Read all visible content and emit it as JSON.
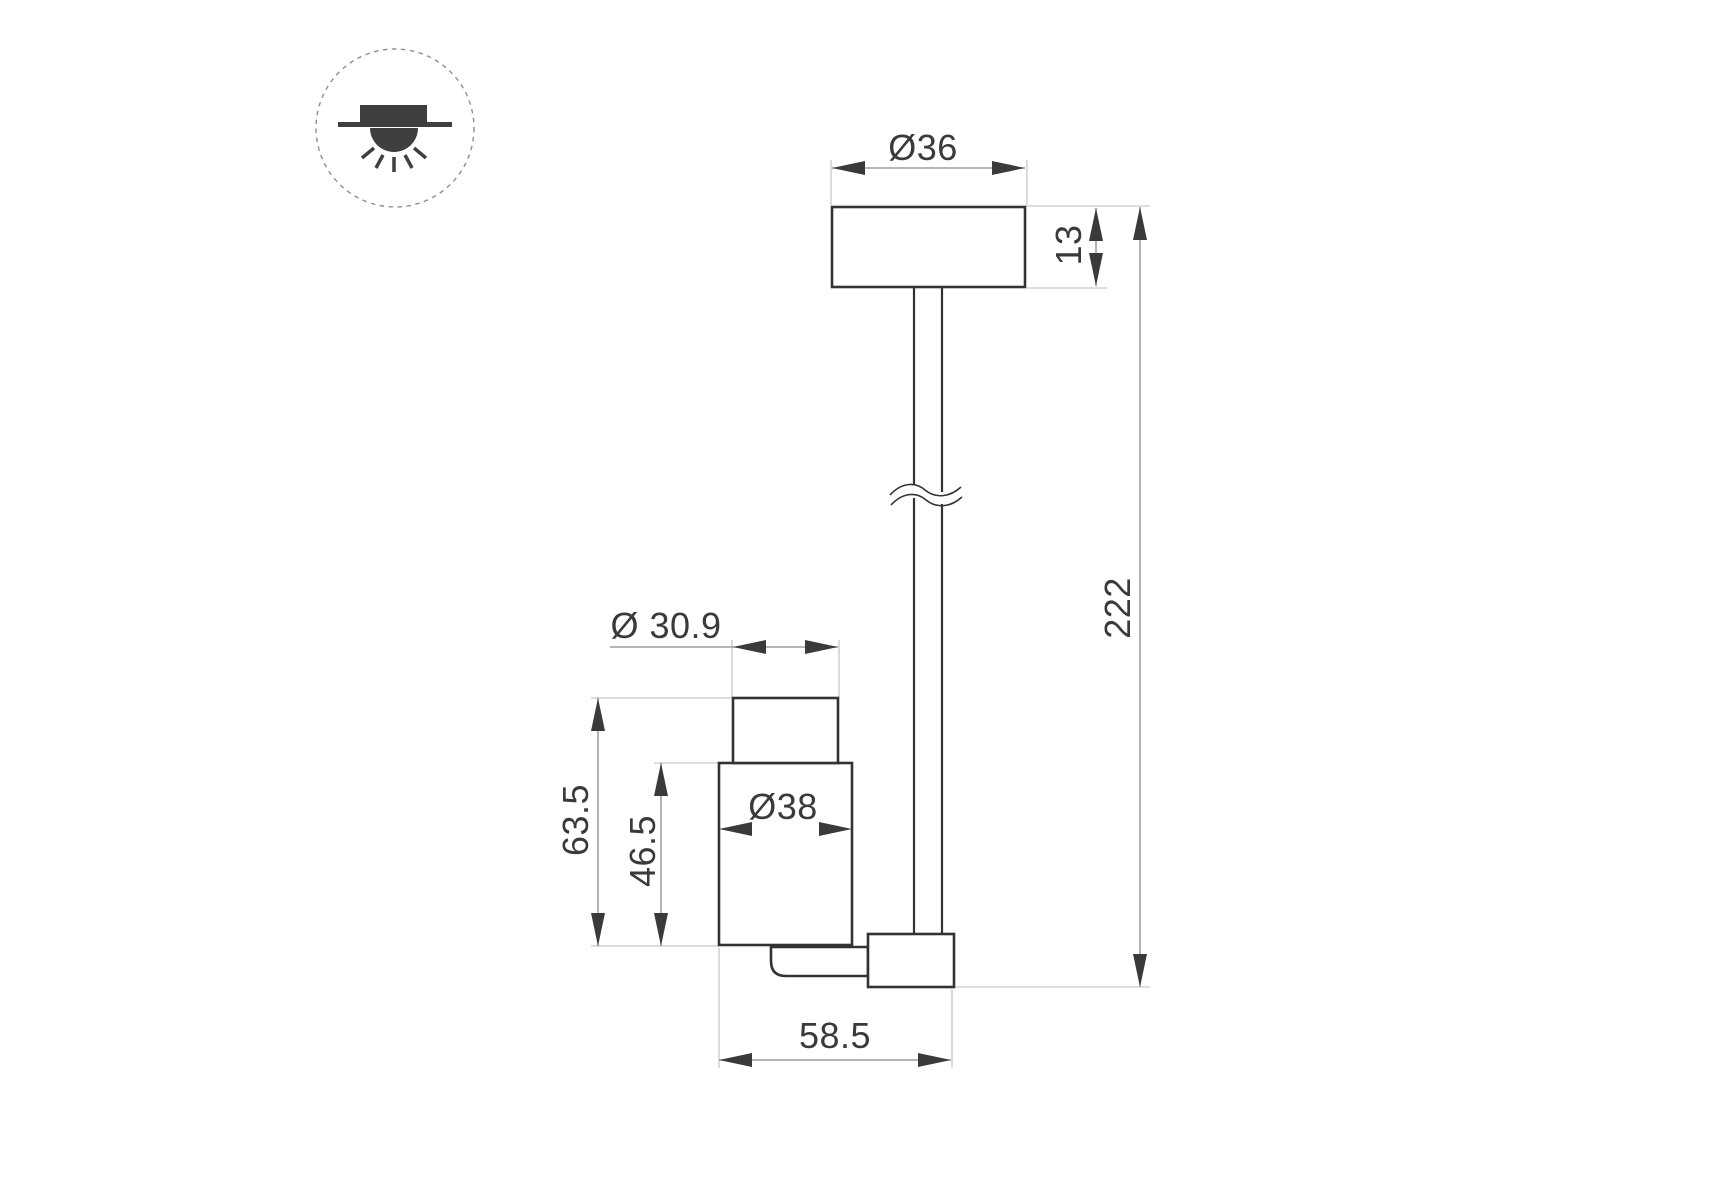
{
  "canvas": {
    "width": 1715,
    "height": 1200,
    "background": "#ffffff"
  },
  "legend": {
    "icon": "surface-mount-ceiling-light-icon"
  },
  "drawing": {
    "kind": "technical-dimension-drawing",
    "dimensions": {
      "canopy_diameter": "Ø36",
      "canopy_height": "13",
      "overall_length": "222",
      "head_neck_diameter": "Ø 30.9",
      "head_body_diameter": "Ø38",
      "head_total_height": "63.5",
      "head_body_height": "46.5",
      "bottom_arm_length": "58.5"
    },
    "colors": {
      "outline": "#333333",
      "dimension_line": "#8a8a8a",
      "extension_line": "#bdbdbd",
      "arrow_and_text": "#3a3a3a",
      "icon_fill": "#3f3f3f",
      "icon_circle_stroke": "#8f8f8f"
    }
  }
}
